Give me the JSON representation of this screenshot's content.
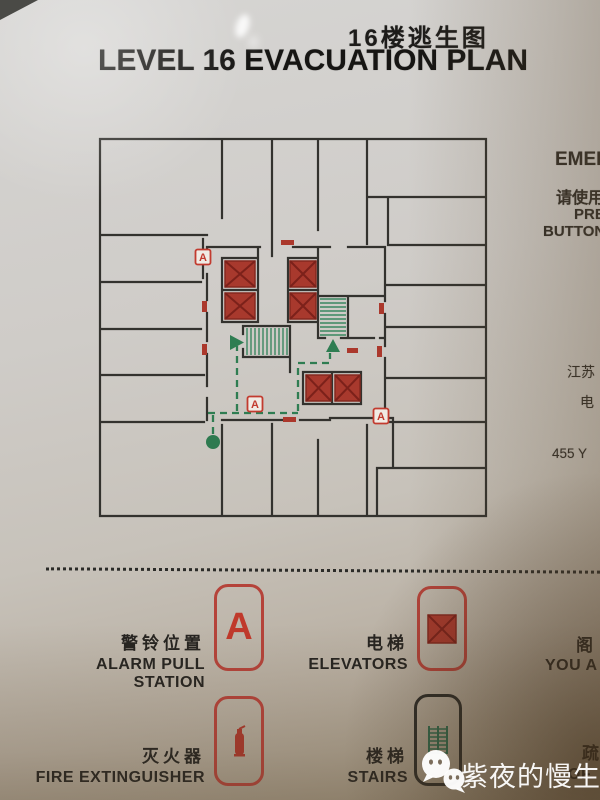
{
  "title": {
    "zh": "16楼逃生图",
    "en": "LEVEL 16 EVACUATION PLAN"
  },
  "side_column": {
    "line1": "EMER",
    "line2": "请使用",
    "line3": "PRE",
    "line4": "BUTTON",
    "line5": "江苏",
    "line6": "电",
    "line7": "455 Y"
  },
  "plan": {
    "marker_letter": "A"
  },
  "legend": {
    "items": [
      {
        "zh": "警铃位置",
        "en": "ALARM PULL STATION",
        "symbol": "A"
      },
      {
        "zh": "电梯",
        "en": "ELEVATORS",
        "symbol": "red-x-square"
      },
      {
        "zh": "灭火器",
        "en": "FIRE EXTINGUISHER",
        "symbol": "extinguisher"
      },
      {
        "zh": "楼梯",
        "en": "STAIRS",
        "symbol": "stairs"
      },
      {
        "zh": "阁",
        "en": "YOU A",
        "symbol": "cropped"
      },
      {
        "zh": "疏",
        "en": "OF",
        "symbol": "cropped"
      }
    ]
  },
  "watermark": {
    "text": "紫夜的慢生活",
    "icon": "wechat-icon"
  },
  "colors": {
    "wall": "#33322e",
    "elevator_red": "#a8392d",
    "stairs_green": "#2f7d52",
    "alarm_red": "#c23b2f",
    "legend_box_red": "#b5433a",
    "legend_box_dark": "#2b2b28"
  }
}
